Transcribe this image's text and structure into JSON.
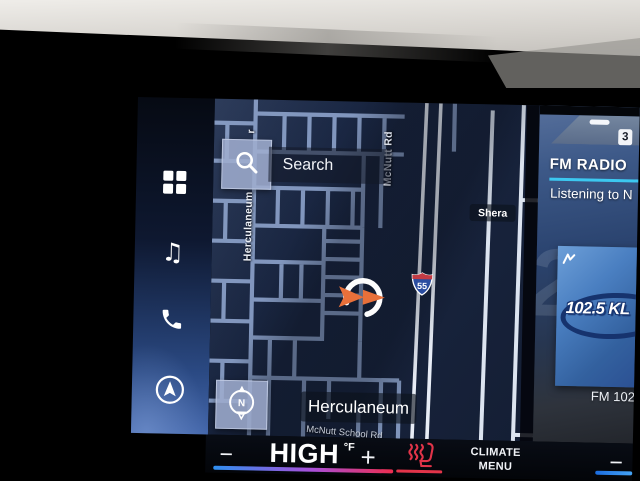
{
  "screen": {
    "sidebar": {
      "icons": [
        "apps-grid-icon",
        "music-note-icon",
        "phone-icon",
        "navigation-arrow-icon"
      ]
    },
    "map": {
      "search_button": {
        "label": "Search",
        "icon": "magnifier-icon"
      },
      "compass_button": {
        "label": "N",
        "icon": "compass-icon"
      },
      "city_label": "Herculaneum",
      "street_label_vertical": "Herculaneum",
      "street_label_partial": "r",
      "road_label_mcnutt": "McNutt Rd",
      "road_label_mcnutt_school": "McNutt School Rd",
      "road_label_sheraton_partial": "Shera",
      "highway_shield_number": "55",
      "location_marker": "orange-arrow-in-circle"
    },
    "radio_widget": {
      "preset_number": "3",
      "title": "FM RADIO",
      "now_playing": "Listening to N",
      "watermark_digit": "2",
      "album_art_logo_text": "102.5 KL",
      "station_caption": "FM 102",
      "accent_color": "#3cc8f0"
    },
    "climate_bar": {
      "driver_minus": "−",
      "driver_temp_value": "HIGH",
      "driver_temp_unit": "°F",
      "driver_plus": "+",
      "menu_label_line1": "CLIMATE",
      "menu_label_line2": "MENU",
      "passenger_minus": "−",
      "seat_heater_color": "#e23449",
      "temp_gradient": [
        "#2f8ff0",
        "#a94fd8",
        "#ec2d4e"
      ]
    }
  }
}
